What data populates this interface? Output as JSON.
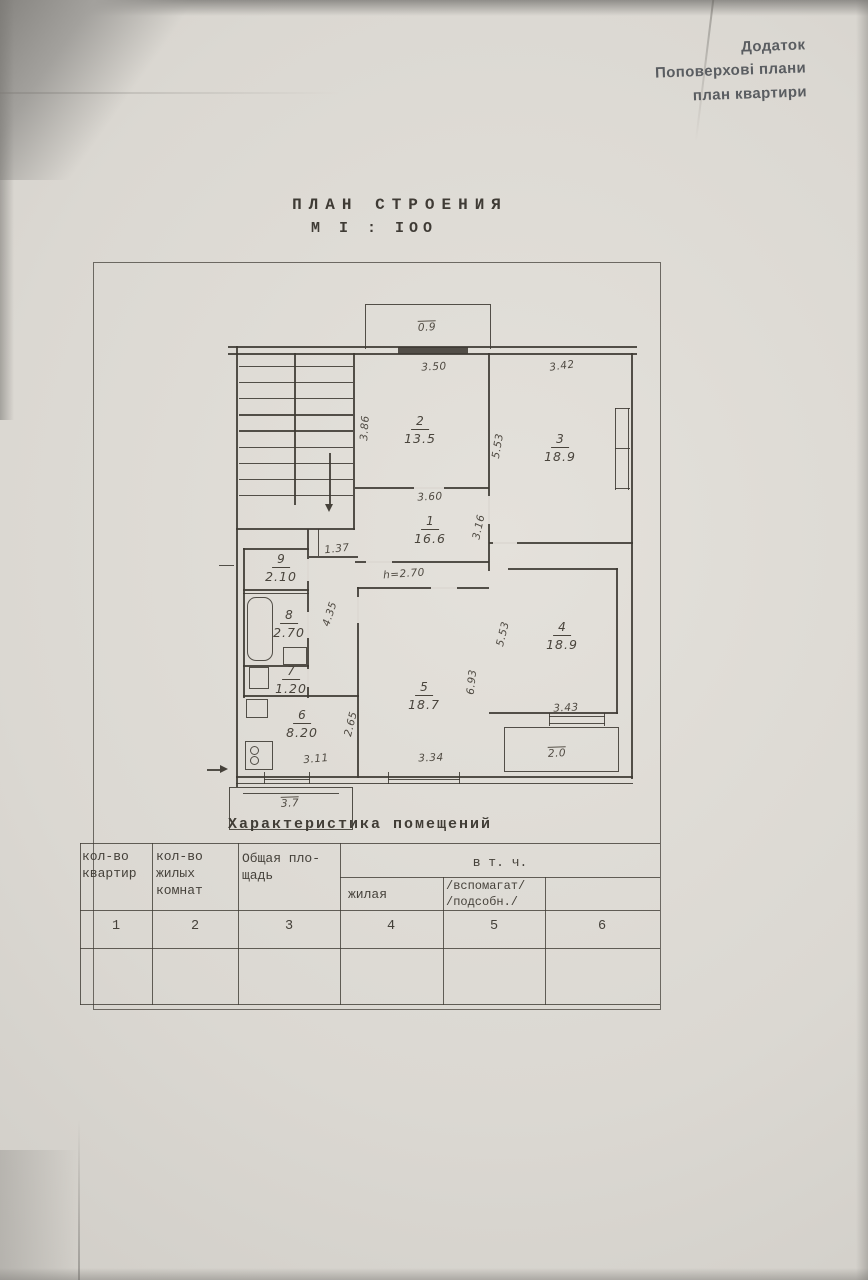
{
  "corner_note": "Додаток\nПоповерхові плани\nплан квартири",
  "title": {
    "line1": "ПЛАН СТРОЕНИЯ",
    "line2": "М I : IОО"
  },
  "plan": {
    "rooms": [
      {
        "n": "1",
        "a": "16.6",
        "x": 430,
        "y": 528
      },
      {
        "n": "2",
        "a": "13.5",
        "x": 420,
        "y": 428
      },
      {
        "n": "3",
        "a": "18.9",
        "x": 560,
        "y": 446
      },
      {
        "n": "4",
        "a": "18.9",
        "x": 562,
        "y": 634
      },
      {
        "n": "5",
        "a": "18.7",
        "x": 424,
        "y": 694
      },
      {
        "n": "6",
        "a": "8.20",
        "x": 302,
        "y": 722
      },
      {
        "n": "7",
        "a": "1.20",
        "x": 291,
        "y": 678
      },
      {
        "n": "8",
        "a": "2.70",
        "x": 289,
        "y": 622
      },
      {
        "n": "9",
        "a": "2.10",
        "x": 281,
        "y": 566
      }
    ],
    "dims": [
      {
        "t": "0.9",
        "x": 427,
        "y": 327,
        "r": -2,
        "o": true
      },
      {
        "t": "3.50",
        "x": 434,
        "y": 367,
        "r": -3
      },
      {
        "t": "3.86",
        "x": 365,
        "y": 428,
        "r": -86
      },
      {
        "t": "3.60",
        "x": 430,
        "y": 497,
        "r": -3
      },
      {
        "t": "3.42",
        "x": 562,
        "y": 366,
        "r": -8
      },
      {
        "t": "5.53",
        "x": 498,
        "y": 446,
        "r": -80
      },
      {
        "t": "3.16",
        "x": 479,
        "y": 527,
        "r": -78
      },
      {
        "t": "1.37",
        "x": 337,
        "y": 549,
        "r": -6
      },
      {
        "t": "h=2.70",
        "x": 404,
        "y": 574,
        "r": -4
      },
      {
        "t": "4.35",
        "x": 330,
        "y": 614,
        "r": -72
      },
      {
        "t": "5.53",
        "x": 503,
        "y": 634,
        "r": -76
      },
      {
        "t": "6.93",
        "x": 472,
        "y": 682,
        "r": -84
      },
      {
        "t": "2.65",
        "x": 351,
        "y": 724,
        "r": -76
      },
      {
        "t": "3.43",
        "x": 566,
        "y": 708,
        "r": -3
      },
      {
        "t": "2.0",
        "x": 557,
        "y": 753,
        "r": -2,
        "o": true
      },
      {
        "t": "3.11",
        "x": 316,
        "y": 759,
        "r": -5
      },
      {
        "t": "3.34",
        "x": 431,
        "y": 758,
        "r": -2
      },
      {
        "t": "3.7",
        "x": 290,
        "y": 803,
        "r": -2,
        "o": true
      }
    ]
  },
  "table": {
    "caption": "Характеристика  помещений",
    "headers": {
      "c1": "кол-во\nквартир",
      "c2": "кол-во\nжилых\nкомнат",
      "c3": "Общая пло-\n  щадь",
      "group": "в  т.  ч.",
      "c4": "жилая",
      "c5": "/вспомагат/\n/подсобн./"
    },
    "numbers": [
      "1",
      "2",
      "3",
      "4",
      "5",
      "6"
    ]
  },
  "colors": {
    "paper": "#dbd8d2",
    "ink": "#45413a"
  }
}
